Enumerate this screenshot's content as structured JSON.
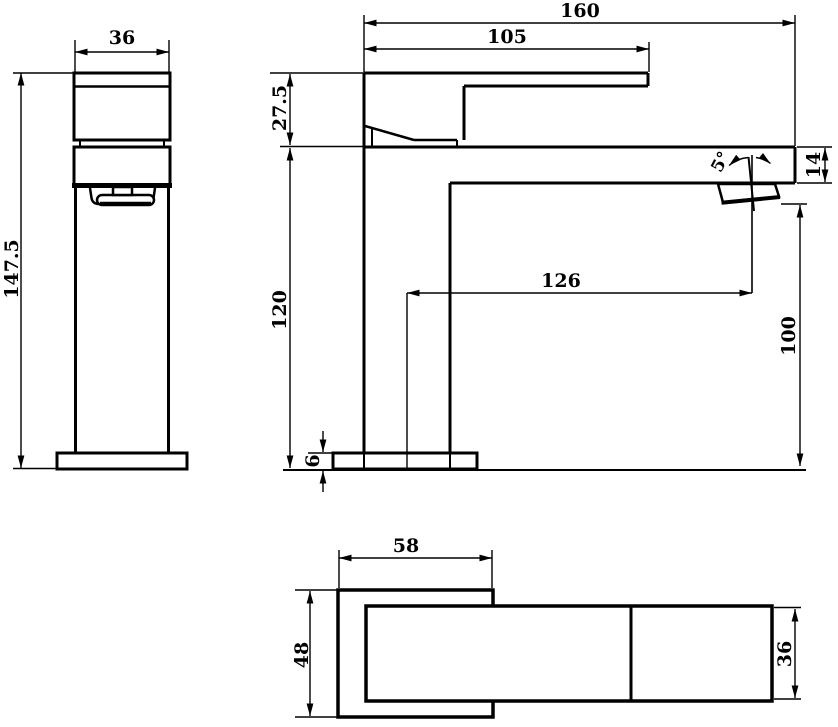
{
  "drawing": {
    "title": "basin mixer tap dimensioned engineering drawing",
    "background_color": "#ffffff",
    "line_color": "#000000",
    "views": [
      "side-view",
      "front-view",
      "plan-view"
    ]
  },
  "labels": {
    "side": {
      "width": "36",
      "height": "147.5"
    },
    "front": {
      "total_length": "160",
      "handle_reach": "105",
      "handle_height": "27.5",
      "body_height": "120",
      "spout_section_height": "14",
      "spout_reach": "126",
      "outlet_clearance": "100",
      "base_thickness": "6",
      "outlet_angle": "5°"
    },
    "plan": {
      "base_length": "58",
      "base_depth": "48",
      "body_width": "36"
    }
  }
}
